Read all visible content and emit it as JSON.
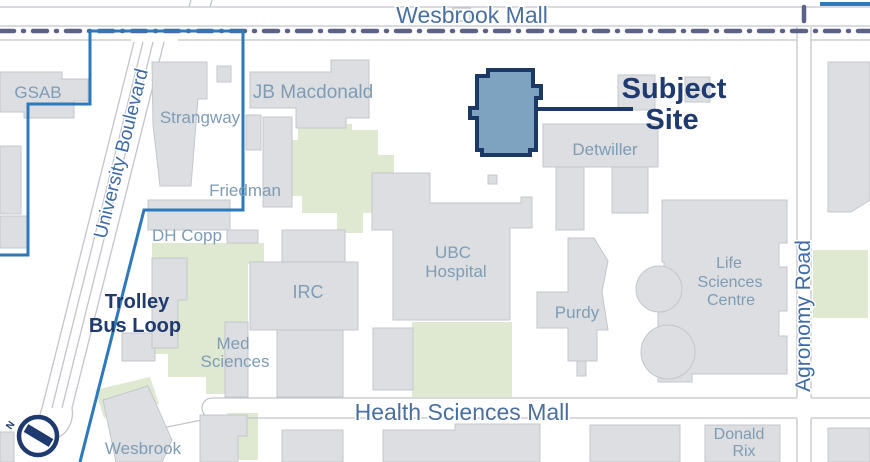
{
  "map": {
    "colors": {
      "background": "#ffffff",
      "building_fill": "#dcdee1",
      "green_fill": "#dfe8d1",
      "road_line": "#c2c5cb",
      "transit_dash": "#5c6187",
      "boundary_blue": "#2d79ba",
      "subject_fill": "#7ea3c0",
      "navy": "#1e3a6e",
      "building_label": "#7e9cb5",
      "road_label": "#4b6f9f"
    },
    "green_areas": [
      {
        "name": "green-central-lawn",
        "points": "298,108 333,108 333,124 352,124 352,130 378,130 378,155 394,155 394,190 380,190 380,213 363,213 363,233 337,233 337,213 302,213 302,196 273,196 273,152 283,152 283,140 298,140"
      },
      {
        "name": "green-west-lawn",
        "points": "152,243 264,243 264,264 248,264 248,394 206,394 206,377 168,377 168,354 152,354"
      },
      {
        "name": "green-hospital-south-lawn",
        "points": "412,322 512,322 512,397 412,397"
      },
      {
        "name": "green-agronomy-east-lawn",
        "points": "813,250 868,250 868,318 813,318"
      },
      {
        "name": "green-bottom-lawn",
        "points": "227,413 258,413 258,460 227,460"
      },
      {
        "name": "green-wesbrook-lawn",
        "points": "95,390 150,377 159,404 104,418"
      }
    ],
    "roads": {
      "lines": [
        [
          0,
          7,
          870,
          7
        ],
        [
          0,
          26,
          870,
          26
        ],
        [
          0,
          40,
          131,
          40
        ],
        [
          178,
          40,
          797,
          40
        ],
        [
          811,
          40,
          870,
          40
        ],
        [
          797,
          27,
          797,
          398
        ],
        [
          811,
          27,
          811,
          398
        ],
        [
          797,
          418,
          797,
          462
        ],
        [
          811,
          418,
          811,
          462
        ],
        [
          212,
          398,
          797,
          398
        ],
        [
          811,
          398,
          870,
          398
        ],
        [
          212,
          418,
          797,
          418
        ],
        [
          811,
          418,
          870,
          418
        ],
        [
          212,
          418,
          152,
          430
        ],
        [
          134,
          42,
          42,
          408
        ],
        [
          143,
          42,
          52,
          408
        ],
        [
          153,
          42,
          62,
          408
        ],
        [
          164,
          42,
          72,
          408
        ],
        [
          191,
          0,
          189,
          7
        ],
        [
          212,
          0,
          210,
          7
        ]
      ],
      "paths": [
        {
          "name": "health-sciences-mall-west-cap",
          "d": "M 212,398 A 10 10 0 0 0 212,418"
        },
        {
          "name": "trolley-loop-cap",
          "d": "M 42,408 A 16 22 14 1 0 72,408"
        }
      ],
      "crosswalk_island": [
        453,
        8,
        17,
        13
      ]
    },
    "transit_dash_lines": [
      {
        "name": "wesbrook-mall-transit-line",
        "d": "M 0,31 L 870,31"
      },
      {
        "name": "agronomy-transit-stub",
        "d": "M 804,7 L 804,27"
      }
    ],
    "boundary": {
      "name": "site-context-boundary",
      "points": "0,255 28,255 28,104 90,104 90,31 243,31 243,210 144,210 80,462"
    },
    "boundary_segment_ne": [
      820,
      4,
      870,
      4
    ],
    "buildings": [
      {
        "name": "gsab-building",
        "points": "0,72 62,72 62,79 88,79 88,101 74,101 74,118 24,118 24,112 0,112"
      },
      {
        "name": "gsab-annex",
        "points": "0,146 21,146 21,214 0,214"
      },
      {
        "name": "west-corner-building",
        "points": "0,216 28,216 28,248 0,248"
      },
      {
        "name": "strangway-building",
        "points": "152,62 207,62 207,99 198,99 191,186 160,186 153,125"
      },
      {
        "name": "strangway-annex",
        "points": "217,66 231,66 231,82 217,82"
      },
      {
        "name": "jb-macdonald-building",
        "points": "250,72 331,72 331,60 369,60 369,118 346,118 346,128 296,128 296,108 250,108"
      },
      {
        "name": "friedman-building",
        "points": "263,117 292,117 292,207 263,207"
      },
      {
        "name": "friedman-annex",
        "points": "246,115 261,115 261,150 246,150"
      },
      {
        "name": "dh-copp-building",
        "points": "148,200 230,200 230,230 148,230"
      },
      {
        "name": "copp-annex",
        "points": "227,230 258,230 258,243 227,243"
      },
      {
        "name": "trolley-building",
        "points": "122,333 155,333 155,361 122,361"
      },
      {
        "name": "boulevard-strip-building",
        "points": "152,258 187,258 187,300 178,300 178,348 152,348"
      },
      {
        "name": "med-sciences-building",
        "points": "225,322 248,322 248,397 225,397"
      },
      {
        "name": "irc-north-wing",
        "points": "282,230 345,230 345,262 282,262"
      },
      {
        "name": "irc-building",
        "points": "250,262 358,262 358,330 250,330"
      },
      {
        "name": "irc-south-wing",
        "points": "277,330 343,330 343,397 277,397"
      },
      {
        "name": "ubc-hospital-building",
        "points": "372,173 430,173 430,203 521,203 521,197 532,197 532,228 510,228 510,320 393,320 393,230 372,230"
      },
      {
        "name": "hospital-annex",
        "points": "373,328 413,328 413,390 373,390"
      },
      {
        "name": "detwiller-main",
        "points": "543,124 658,124 658,167 543,167"
      },
      {
        "name": "detwiller-tower-south",
        "points": "556,167 584,167 584,230 556,230"
      },
      {
        "name": "detwiller-tower-east",
        "points": "612,167 648,167 648,213 612,213"
      },
      {
        "name": "detwiller-north-annex",
        "points": "618,75 655,75 655,110 618,110"
      },
      {
        "name": "north-annex-2",
        "points": "685,77 710,77 710,102 685,102"
      },
      {
        "name": "small-block",
        "points": "488,175 497,175 497,184 488,184"
      },
      {
        "name": "purdy-building",
        "points": "568,238 594,238 608,261 602,292 608,330 597,330 597,361 568,361 568,328 537,328 537,292 568,292"
      },
      {
        "name": "purdy-foot",
        "points": "577,361 586,361 586,376 577,376"
      },
      {
        "name": "life-sciences-centre-building",
        "points": "662,200 787,200 787,243 779,243 779,267 787,267 787,311 779,311 779,336 787,336 787,374 692,374 692,382 658,382 658,312 664,312 664,262 662,262"
      },
      {
        "name": "ne-tall-building",
        "points": "828,62 870,62 870,200 851,212 828,212"
      },
      {
        "name": "wesbrook-building",
        "points": "103,400 148,386 172,440 162,462 116,462"
      },
      {
        "name": "bottom-building-1",
        "points": "200,415 247,415 247,436 238,436 238,462 200,462"
      },
      {
        "name": "bottom-building-2",
        "points": "282,430 343,430 343,462 282,462"
      },
      {
        "name": "bottom-building-3",
        "points": "383,430 455,430 455,424 540,424 540,462 383,462"
      },
      {
        "name": "bottom-building-4",
        "points": "590,425 680,425 680,462 590,462"
      },
      {
        "name": "donald-rix-building",
        "points": "705,425 780,425 780,462 705,462"
      },
      {
        "name": "bottom-right-building",
        "points": "828,428 870,428 870,462 828,462"
      },
      {
        "name": "sw-corner-building",
        "points": "0,432 14,432 14,462 0,462"
      }
    ],
    "building_circles": [
      {
        "name": "lsc-apse-1",
        "cx": 659,
        "cy": 289,
        "r": 23
      },
      {
        "name": "lsc-apse-2",
        "cx": 668,
        "cy": 352,
        "r": 27
      }
    ],
    "subject_site": {
      "polygon": "488,70 533,70 533,86 541,86 541,98 536,98 536,150 530,150 530,155 482,155 482,150 477,150 477,118 470,118 470,108 477,108 477,76 488,76",
      "leader": [
        536,
        109,
        633,
        109
      ],
      "label_line1": "Subject",
      "label_line2": "Site"
    },
    "compass": {
      "cx": 38,
      "cy": 436,
      "r": 19,
      "needle": [
        26,
        428,
        51,
        443
      ],
      "label": "N"
    },
    "labels": [
      {
        "id": "wesbrook-mall",
        "text": "Wesbrook Mall",
        "x": 472,
        "y": 23,
        "size": 23,
        "cls": "roadl"
      },
      {
        "id": "health-sciences-mall",
        "text": "Health Sciences Mall",
        "x": 462,
        "y": 420,
        "size": 23,
        "cls": "roadl"
      },
      {
        "id": "agronomy-road",
        "text": "Agronomy Road",
        "x": 810,
        "y": 316,
        "size": 21,
        "cls": "hwyl",
        "rot": -90
      },
      {
        "id": "university-boulevard",
        "text": "University Boulevard",
        "x": 127,
        "y": 155,
        "size": 19,
        "cls": "hwyl",
        "rot": -76
      },
      {
        "id": "gsab",
        "text": "GSAB",
        "x": 38,
        "y": 98,
        "size": 17,
        "cls": "bldgl"
      },
      {
        "id": "strangway",
        "text": "Strangway",
        "x": 200,
        "y": 123,
        "size": 17,
        "cls": "bldgl"
      },
      {
        "id": "jb-macdonald",
        "text": "JB Macdonald",
        "x": 313,
        "y": 98,
        "size": 19,
        "cls": "bldgl"
      },
      {
        "id": "friedman",
        "text": "Friedman",
        "x": 245,
        "y": 196,
        "size": 17,
        "cls": "bldgl"
      },
      {
        "id": "dh-copp",
        "text": "DH Copp",
        "x": 187,
        "y": 241,
        "size": 17,
        "cls": "bldgl"
      },
      {
        "id": "med",
        "text": "Med",
        "x": 233,
        "y": 349,
        "size": 17,
        "cls": "bldgl"
      },
      {
        "id": "med-sciences",
        "text": "Sciences",
        "x": 235,
        "y": 367,
        "size": 17,
        "cls": "bldgl"
      },
      {
        "id": "irc",
        "text": "IRC",
        "x": 308,
        "y": 298,
        "size": 18,
        "cls": "bldgl"
      },
      {
        "id": "ubc",
        "text": "UBC",
        "x": 453,
        "y": 258,
        "size": 17,
        "cls": "bldgl"
      },
      {
        "id": "hospital",
        "text": "Hospital",
        "x": 456,
        "y": 277,
        "size": 17,
        "cls": "bldgl"
      },
      {
        "id": "purdy",
        "text": "Purdy",
        "x": 577,
        "y": 318,
        "size": 17,
        "cls": "bldgl"
      },
      {
        "id": "detwiller",
        "text": "Detwiller",
        "x": 605,
        "y": 155,
        "size": 17,
        "cls": "bldgl"
      },
      {
        "id": "lsc-life",
        "text": "Life",
        "x": 729,
        "y": 268,
        "size": 16,
        "cls": "bldgl"
      },
      {
        "id": "lsc-sciences",
        "text": "Sciences",
        "x": 730,
        "y": 287,
        "size": 16,
        "cls": "bldgl"
      },
      {
        "id": "lsc-centre",
        "text": "Centre",
        "x": 731,
        "y": 305,
        "size": 16,
        "cls": "bldgl"
      },
      {
        "id": "donald",
        "text": "Donald",
        "x": 739,
        "y": 439,
        "size": 16,
        "cls": "bldgl"
      },
      {
        "id": "rix",
        "text": "Rix",
        "x": 744,
        "y": 456,
        "size": 16,
        "cls": "bldgl"
      },
      {
        "id": "wesbrook-building",
        "text": "Wesbrook",
        "x": 143,
        "y": 454,
        "size": 17,
        "cls": "bldgl"
      },
      {
        "id": "trolley",
        "text": "Trolley",
        "x": 137,
        "y": 308,
        "size": 20,
        "cls": "navyl"
      },
      {
        "id": "bus-loop",
        "text": "Bus Loop",
        "x": 135,
        "y": 332,
        "size": 20,
        "cls": "navyl"
      },
      {
        "id": "subject",
        "text": "Subject",
        "x": 674,
        "y": 98,
        "size": 29,
        "cls": "subjectl"
      },
      {
        "id": "site",
        "text": "Site",
        "x": 672,
        "y": 129,
        "size": 29,
        "cls": "subjectl"
      },
      {
        "id": "compass-n",
        "text": "N",
        "x": 13,
        "y": 427,
        "size": 10,
        "cls": "navyl",
        "rot": -55
      }
    ]
  }
}
